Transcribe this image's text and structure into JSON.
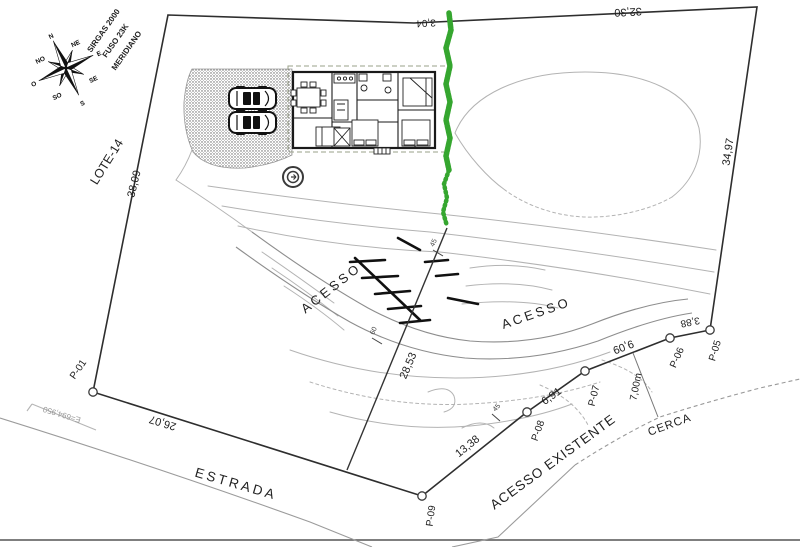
{
  "colors": {
    "green_path": "#35a62f",
    "boundary": "#2e2e2e",
    "contour": "#b3b3b3",
    "road": "#9b9b9b"
  },
  "compass": {
    "points": [
      "N",
      "NE",
      "E",
      "SE",
      "S",
      "SO",
      "O",
      "NO"
    ]
  },
  "labels": [
    {
      "name": "datum-note-line1",
      "text": "SIRGAS 2000",
      "x": 104,
      "y": 31,
      "r": -55,
      "size": 8,
      "weight": 700
    },
    {
      "name": "datum-note-line2",
      "text": "FUSO 23K",
      "x": 116,
      "y": 41,
      "r": -55,
      "size": 8,
      "weight": 700
    },
    {
      "name": "datum-note-line3",
      "text": "MERIDIANO",
      "x": 127,
      "y": 51,
      "r": -55,
      "size": 8,
      "weight": 700
    },
    {
      "name": "lot-label",
      "text": "LOTE-14",
      "x": 107,
      "y": 162,
      "r": -58,
      "size": 12.5
    },
    {
      "name": "dim-west-boundary",
      "text": "38,09",
      "x": 135,
      "y": 184,
      "r": -76,
      "size": 11
    },
    {
      "name": "dim-top-small",
      "text": "3,04",
      "x": 426,
      "y": 22,
      "r": 177,
      "size": 10
    },
    {
      "name": "dim-north-boundary",
      "text": "32,30",
      "x": 628,
      "y": 11,
      "r": 177,
      "size": 11
    },
    {
      "name": "dim-east-boundary",
      "text": "34,97",
      "x": 729,
      "y": 152,
      "r": -81,
      "size": 11
    },
    {
      "name": "acesso-upper-label",
      "text": "ACESSO",
      "x": 331,
      "y": 288,
      "r": -38,
      "size": 13,
      "ls": 3
    },
    {
      "name": "acesso-lower-label",
      "text": "ACESSO",
      "x": 536,
      "y": 313,
      "r": -19,
      "size": 13,
      "ls": 3
    },
    {
      "name": "dim-division-line",
      "text": "28,53",
      "x": 409,
      "y": 366,
      "r": -67,
      "size": 11
    },
    {
      "name": "dim-southwest-boundary",
      "text": "26,07",
      "x": 163,
      "y": 422,
      "r": 197,
      "size": 11
    },
    {
      "name": "dim-p09-p08",
      "text": "13,38",
      "x": 468,
      "y": 447,
      "r": -39,
      "size": 11
    },
    {
      "name": "dim-p08-p07",
      "text": "6,91",
      "x": 552,
      "y": 397,
      "r": -35,
      "size": 11
    },
    {
      "name": "dim-p07-p06",
      "text": "9,09",
      "x": 623,
      "y": 346,
      "r": 159,
      "size": 11
    },
    {
      "name": "dim-p06-p05",
      "text": "3,88",
      "x": 690,
      "y": 321,
      "r": 169,
      "size": 10
    },
    {
      "name": "point-label-p01",
      "text": "P-01",
      "x": 79,
      "y": 370,
      "r": -55,
      "size": 10
    },
    {
      "name": "point-label-p09",
      "text": "P-09",
      "x": 432,
      "y": 516,
      "r": -82,
      "size": 10
    },
    {
      "name": "point-label-p08",
      "text": "P-08",
      "x": 539,
      "y": 431,
      "r": -70,
      "size": 10
    },
    {
      "name": "point-label-p07",
      "text": "P-07",
      "x": 595,
      "y": 396,
      "r": -76,
      "size": 10
    },
    {
      "name": "point-label-p06",
      "text": "P-06",
      "x": 678,
      "y": 358,
      "r": -66,
      "size": 10
    },
    {
      "name": "point-label-p05",
      "text": "P-05",
      "x": 716,
      "y": 351,
      "r": -73,
      "size": 10
    },
    {
      "name": "dim-fence-offset",
      "text": "7,00m",
      "x": 637,
      "y": 387,
      "r": -79,
      "size": 10
    },
    {
      "name": "cerca-label",
      "text": "CERCA",
      "x": 670,
      "y": 426,
      "r": -20,
      "size": 11.5,
      "ls": 1
    },
    {
      "name": "acesso-existente-label",
      "text": "ACESSO EXISTENTE",
      "x": 553,
      "y": 462,
      "r": -36,
      "size": 13.5,
      "ls": 1
    },
    {
      "name": "estrada-label",
      "text": "ESTRADA",
      "x": 236,
      "y": 484,
      "r": 16,
      "size": 13.5,
      "ls": 3
    },
    {
      "name": "grid-coordinate-label",
      "text": "E=694,950",
      "x": 62,
      "y": 414,
      "r": 197,
      "size": 8,
      "color": "#999999"
    },
    {
      "name": "elevation-tick-45-upper",
      "text": "45",
      "x": 434,
      "y": 243,
      "r": -65,
      "size": 7,
      "color": "#444444"
    },
    {
      "name": "elevation-tick-60",
      "text": "60",
      "x": 374,
      "y": 331,
      "r": -65,
      "size": 7,
      "color": "#444444"
    },
    {
      "name": "elevation-tick-45-lower",
      "text": "45",
      "x": 497,
      "y": 408,
      "r": -48,
      "size": 7,
      "color": "#444444"
    }
  ]
}
